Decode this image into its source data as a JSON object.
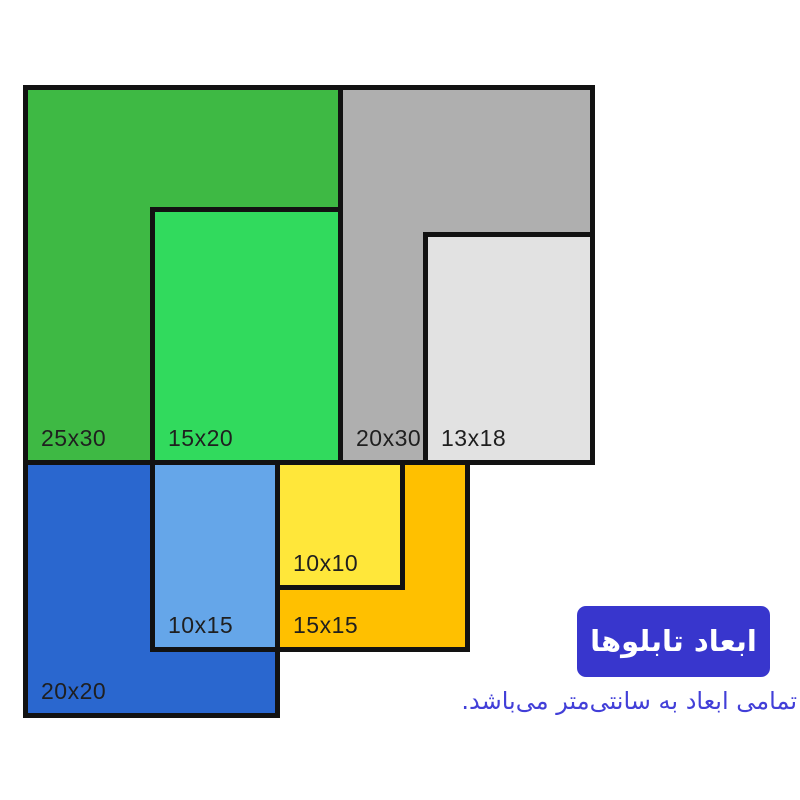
{
  "canvas": {
    "width": 800,
    "height": 800,
    "background": "#ffffff"
  },
  "diagram": {
    "unit": "cm",
    "px_per_cm": 12.65,
    "border_color": "#121212",
    "border_px": 5,
    "label_color": "#1f1f1f",
    "frames": [
      {
        "name": "frame-25x30",
        "label": "25x30",
        "width_cm": 25,
        "height_cm": 30,
        "color": "#3eb944",
        "rect_px": {
          "x": 23,
          "y": 85,
          "w": 320,
          "h": 380
        }
      },
      {
        "name": "frame-15x20",
        "label": "15x20",
        "width_cm": 15,
        "height_cm": 20,
        "color": "#31da5d",
        "rect_px": {
          "x": 150,
          "y": 207,
          "w": 193,
          "h": 258
        }
      },
      {
        "name": "frame-20x30",
        "label": "20x30",
        "width_cm": 20,
        "height_cm": 30,
        "color": "#afafaf",
        "rect_px": {
          "x": 338,
          "y": 85,
          "w": 257,
          "h": 380
        }
      },
      {
        "name": "frame-13x18",
        "label": "13x18",
        "width_cm": 13,
        "height_cm": 18,
        "color": "#e2e2e2",
        "rect_px": {
          "x": 423,
          "y": 232,
          "w": 172,
          "h": 233
        }
      },
      {
        "name": "frame-20x20",
        "label": "20x20",
        "width_cm": 20,
        "height_cm": 20,
        "color": "#2a67cf",
        "rect_px": {
          "x": 23,
          "y": 460,
          "w": 257,
          "h": 258
        }
      },
      {
        "name": "frame-10x15",
        "label": "10x15",
        "width_cm": 10,
        "height_cm": 15,
        "color": "#65a6e9",
        "rect_px": {
          "x": 150,
          "y": 460,
          "w": 130,
          "h": 192
        }
      },
      {
        "name": "frame-15x15",
        "label": "15x15",
        "width_cm": 15,
        "height_cm": 15,
        "color": "#ffc000",
        "rect_px": {
          "x": 275,
          "y": 460,
          "w": 195,
          "h": 192
        }
      },
      {
        "name": "frame-10x10",
        "label": "10x10",
        "width_cm": 10,
        "height_cm": 10,
        "color": "#ffe73a",
        "rect_px": {
          "x": 275,
          "y": 460,
          "w": 130,
          "h": 130
        }
      }
    ]
  },
  "legend": {
    "badge_label": "ابعاد تابلوها",
    "badge_color": "#3836cd",
    "badge_text_color": "#ffffff",
    "subtitle": "تمامی ابعاد به سانتی‌متر می‌باشد.",
    "subtitle_color": "#423fd8"
  }
}
